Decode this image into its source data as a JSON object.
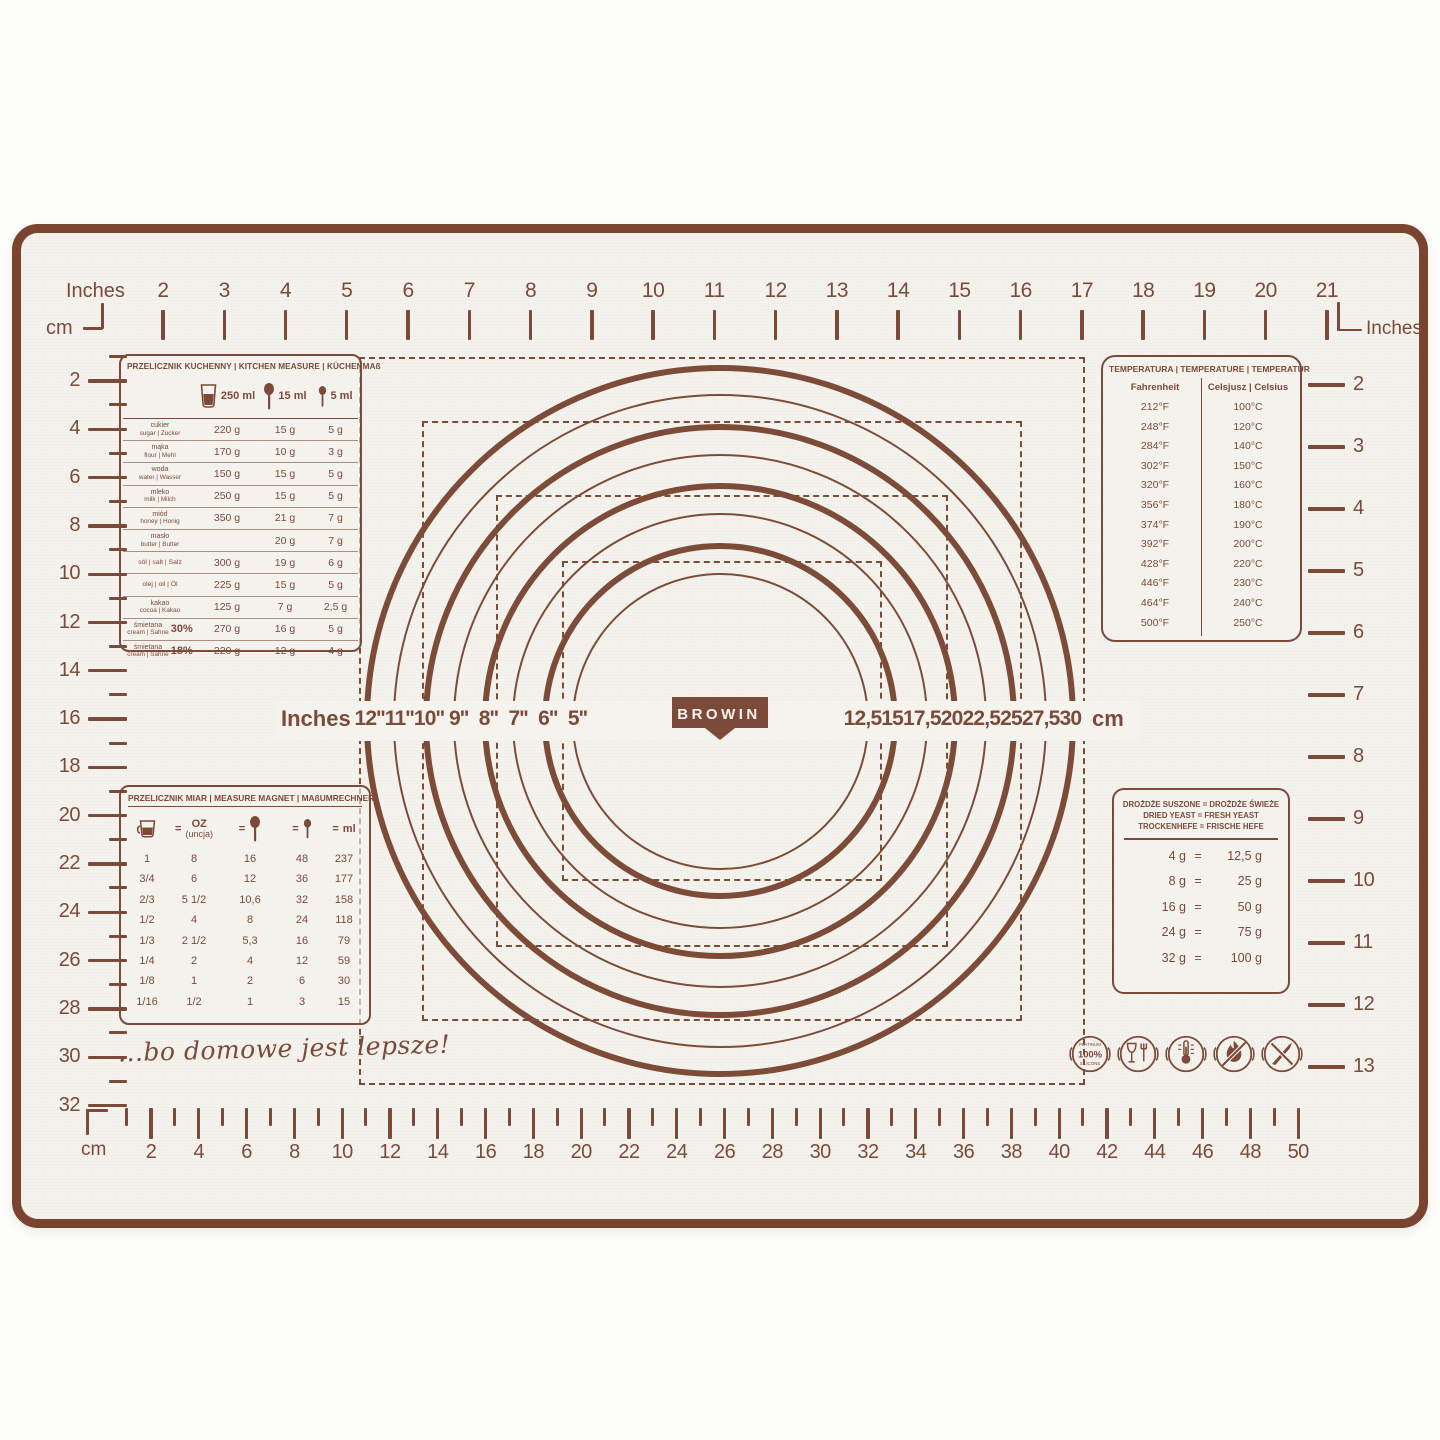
{
  "colors": {
    "print": "#7b4a38",
    "trim": "#7a4431",
    "mat_bg": "#f5f3ee",
    "page_bg": "#fdfdfb"
  },
  "brand": {
    "logo_text": "BROWIN",
    "tagline": "...bo domowe jest lepsze!"
  },
  "top_ruler": {
    "label_left": "Inches",
    "label_left_secondary": "cm",
    "label_right": "Inches",
    "labels": [
      2,
      3,
      4,
      5,
      6,
      7,
      8,
      9,
      10,
      11,
      12,
      13,
      14,
      15,
      16,
      17,
      18,
      19,
      20,
      21
    ]
  },
  "left_ruler": {
    "labels": [
      2,
      4,
      6,
      8,
      10,
      12,
      14,
      16,
      18,
      20,
      22,
      24,
      26,
      28,
      30,
      32
    ]
  },
  "right_ruler": {
    "labels": [
      2,
      3,
      4,
      5,
      6,
      7,
      8,
      9,
      10,
      11,
      12,
      13
    ]
  },
  "bottom_ruler": {
    "label": "cm",
    "labels": [
      2,
      4,
      6,
      8,
      10,
      12,
      14,
      16,
      18,
      20,
      22,
      24,
      26,
      28,
      30,
      32,
      34,
      36,
      38,
      40,
      42,
      44,
      46,
      48,
      50
    ]
  },
  "circle_gauge": {
    "left_unit_label": "Inches",
    "right_unit_label": "cm",
    "circles": [
      {
        "inches_label": "12''",
        "cm_label": "30",
        "cm": 30,
        "thick": true
      },
      {
        "inches_label": "11''",
        "cm_label": "27,5",
        "cm": 27.5,
        "thick": false
      },
      {
        "inches_label": "10''",
        "cm_label": "25",
        "cm": 25,
        "thick": true
      },
      {
        "inches_label": "9''",
        "cm_label": "22,5",
        "cm": 22.5,
        "thick": false
      },
      {
        "inches_label": "8''",
        "cm_label": "20",
        "cm": 20,
        "thick": true
      },
      {
        "inches_label": "7''",
        "cm_label": "17,5",
        "cm": 17.5,
        "thick": false
      },
      {
        "inches_label": "6''",
        "cm_label": "15",
        "cm": 15,
        "thick": true
      },
      {
        "inches_label": "5''",
        "cm_label": "12,5",
        "cm": 12.5,
        "thick": false
      }
    ]
  },
  "kitchen_table": {
    "title": "PRZELICZNIK KUCHENNY | KITCHEN MEASURE | KÜCHENMAß",
    "columns": [
      {
        "icon": "measuring-cup-icon",
        "label": "250 ml"
      },
      {
        "icon": "tablespoon-icon",
        "label": "15 ml"
      },
      {
        "icon": "teaspoon-icon",
        "label": "5 ml"
      }
    ],
    "rows": [
      {
        "name_top": "cukier",
        "name_bottom": "sugar | Zucker",
        "pct": "",
        "values": [
          "220 g",
          "15 g",
          "5 g"
        ]
      },
      {
        "name_top": "mąka",
        "name_bottom": "flour | Mehl",
        "pct": "",
        "values": [
          "170 g",
          "10 g",
          "3 g"
        ]
      },
      {
        "name_top": "woda",
        "name_bottom": "water | Wasser",
        "pct": "",
        "values": [
          "150 g",
          "15 g",
          "5 g"
        ]
      },
      {
        "name_top": "mleko",
        "name_bottom": "milk | Milch",
        "pct": "",
        "values": [
          "250 g",
          "15 g",
          "5 g"
        ]
      },
      {
        "name_top": "miód",
        "name_bottom": "honey | Honig",
        "pct": "",
        "values": [
          "350 g",
          "21 g",
          "7 g"
        ]
      },
      {
        "name_top": "masło",
        "name_bottom": "butter | Butter",
        "pct": "",
        "values": [
          "",
          "20 g",
          "7 g"
        ]
      },
      {
        "name_top": "sól | salt | Salz",
        "name_bottom": "",
        "pct": "",
        "values": [
          "300 g",
          "19 g",
          "6 g"
        ]
      },
      {
        "name_top": "olej | oil | Öl",
        "name_bottom": "",
        "pct": "",
        "values": [
          "225 g",
          "15 g",
          "5 g"
        ]
      },
      {
        "name_top": "kakao",
        "name_bottom": "cocoa | Kakao",
        "pct": "",
        "values": [
          "125 g",
          "7 g",
          "2,5 g"
        ]
      },
      {
        "name_top": "śmietana",
        "name_bottom": "cream | Sahne",
        "pct": "30%",
        "values": [
          "270 g",
          "16 g",
          "5 g"
        ]
      },
      {
        "name_top": "śmietana",
        "name_bottom": "cream | Sahne",
        "pct": "18%",
        "values": [
          "220 g",
          "12 g",
          "4 g"
        ]
      }
    ]
  },
  "temperature_table": {
    "title": "TEMPERATURA | TEMPERATURE | TEMPERATUR",
    "col1": "Fahrenheit",
    "col2": "Celsjusz | Celsius",
    "rows": [
      [
        "212°F",
        "100°C"
      ],
      [
        "248°F",
        "120°C"
      ],
      [
        "284°F",
        "140°C"
      ],
      [
        "302°F",
        "150°C"
      ],
      [
        "320°F",
        "160°C"
      ],
      [
        "356°F",
        "180°C"
      ],
      [
        "374°F",
        "190°C"
      ],
      [
        "392°F",
        "200°C"
      ],
      [
        "428°F",
        "220°C"
      ],
      [
        "446°F",
        "230°C"
      ],
      [
        "464°F",
        "240°C"
      ],
      [
        "500°F",
        "250°C"
      ]
    ]
  },
  "measure_table": {
    "title": "PRZELICZNIK MIAR | MEASURE MAGNET | MAßUMRECHNER",
    "header": {
      "col1_icon": "measuring-cup-icon",
      "col2_line1": "OZ",
      "col2_line2": "(uncja)",
      "col3_icon": "tablespoon-icon",
      "col4_icon": "teaspoon-icon",
      "col5": "ml",
      "equals": "="
    },
    "rows": [
      [
        "1",
        "8",
        "16",
        "48",
        "237"
      ],
      [
        "3/4",
        "6",
        "12",
        "36",
        "177"
      ],
      [
        "2/3",
        "5 1/2",
        "10,6",
        "32",
        "158"
      ],
      [
        "1/2",
        "4",
        "8",
        "24",
        "118"
      ],
      [
        "1/3",
        "2 1/2",
        "5,3",
        "16",
        "79"
      ],
      [
        "1/4",
        "2",
        "4",
        "12",
        "59"
      ],
      [
        "1/8",
        "1",
        "2",
        "6",
        "30"
      ],
      [
        "1/16",
        "1/2",
        "1",
        "3",
        "15"
      ]
    ]
  },
  "yeast_table": {
    "title_lines": [
      "DROŻDŻE SUSZONE = DROŻDŻE ŚWIEŻE",
      "DRIED YEAST = FRESH YEAST",
      "TROCKENHEFE = FRISCHE HEFE"
    ],
    "equals": "=",
    "rows": [
      [
        "4 g",
        "12,5 g"
      ],
      [
        "8 g",
        "25 g"
      ],
      [
        "16 g",
        "50 g"
      ],
      [
        "24 g",
        "75 g"
      ],
      [
        "32 g",
        "100 g"
      ]
    ]
  },
  "badges": {
    "platinum_lines": [
      "PLATINUM",
      "100%",
      "SILICONE"
    ],
    "items": [
      "platinum-100-silicone-badge",
      "food-contact-safe-icon",
      "temperature-range-icon",
      "flame-resistant-icon",
      "no-cutting-icon"
    ]
  }
}
